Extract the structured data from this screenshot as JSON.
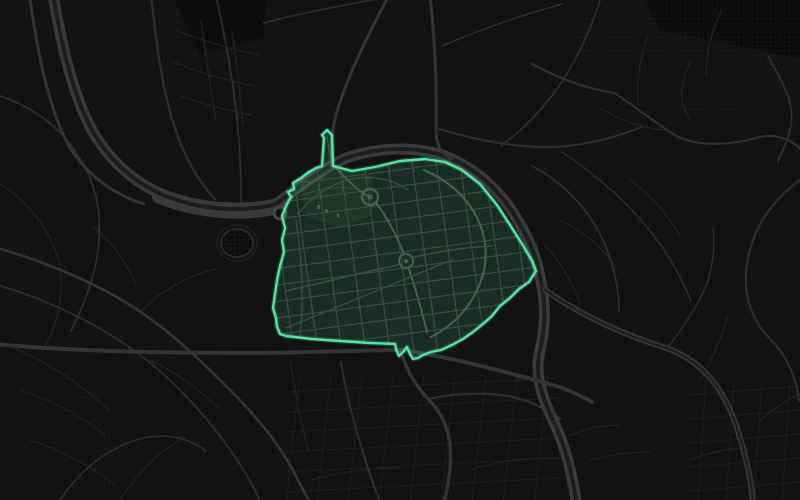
{
  "map": {
    "canvas": {
      "width": 800,
      "height": 500
    },
    "palette": {
      "background": "#121212",
      "block": "#0c0c0c",
      "dot": "#232323",
      "grid_faint": "#1e1e1e",
      "road_thin": "#242424",
      "road_medium": "#2e2e2e",
      "road_major": "#343434",
      "water": "#3a3a3a",
      "water_core": "#1d1d1d",
      "landmark_ring": "#454545",
      "stadium_fill": "#0e0e0e",
      "stadium_stroke": "#282828",
      "district_street": "#3a4f43",
      "district_street_bright": "#485f50"
    },
    "blocks": [
      "M 172,-5 L 266,-5 L 264,38 L 200,54 Z",
      "M 640,-5 L 805,-5 L 805,60 L 660,30 Z"
    ],
    "texture_patches": [
      {
        "d": "M 560,20 L 660,-5 L 805,-5 L 805,95 L 700,120 L 600,80 Z",
        "opacity": 0.55
      },
      {
        "d": "M -5,205 L 40,215 L 70,260 L 60,320 L 5,330 Z",
        "opacity": 0.5
      },
      {
        "d": "M -5,355 L 120,385 L 230,455 L 260,505 L -5,505 Z",
        "opacity": 0.45
      },
      {
        "d": "M 95,-5 L 170,-5 L 198,58 L 150,118 L 100,80 Z",
        "opacity": 0.5
      }
    ],
    "grids": [
      {
        "n": 6,
        "x1": 284,
        "y1": 392,
        "x2": 560,
        "y2": 378,
        "sx": 0,
        "sy": 20
      },
      {
        "n": 9,
        "x1": 300,
        "y1": 375,
        "x2": 286,
        "y2": 503,
        "sx": 31,
        "sy": 0
      },
      {
        "n": 5,
        "x1": 688,
        "y1": 395,
        "x2": 802,
        "y2": 386,
        "sx": 0,
        "sy": 24
      },
      {
        "n": 4,
        "x1": 706,
        "y1": 380,
        "x2": 698,
        "y2": 503,
        "sx": 28,
        "sy": 0
      }
    ],
    "water": {
      "wide_d": "M 160,196 C 200,212 245,214 278,206",
      "d": "M 52,-10 C 60,35 70,90 93,132 C 112,164 138,185 168,197 C 205,211 248,212 276,204 C 298,188 320,170 346,158 C 382,146 420,146 450,158 C 480,171 502,194 517,219 C 529,239 536,256 539,272 C 545,297 547,322 540,350 C 533,378 545,403 557,429 C 566,450 572,473 576,500"
    },
    "roads": {
      "major": [
        {
          "d": "M 545,290 C 585,318 628,336 666,348 C 700,360 722,385 736,425 C 746,455 751,478 753,502",
          "w": 6,
          "core": 2
        },
        {
          "d": "M -5,344 C 80,352 180,353 266,353 C 320,352 370,350 400,350 C 440,355 492,368 546,383 C 565,388 580,395 592,402",
          "w": 4
        },
        {
          "d": "M 403,357 C 408,374 418,388 428,399 C 441,412 448,426 450,446 C 452,466 448,486 444,502",
          "w": 3.5
        },
        {
          "d": "M 430,-5 C 435,40 437,90 436,130 C 436,146 441,153 452,159",
          "w": 3
        },
        {
          "d": "M 390,-6 C 371,28 352,68 341,99 C 334,118 330,141 331,164",
          "w": 3
        },
        {
          "d": "M 29,-8 C 37,50 48,108 70,148 C 88,176 113,194 144,204",
          "w": 3
        },
        {
          "d": "M -6,247 C 40,260 90,280 130,305 C 170,330 201,361 230,390 C 256,416 281,446 296,476 C 302,488 307,497 310,503",
          "w": 2.6
        }
      ],
      "medium": [
        {
          "d": "M 151,-4 C 156,40 161,80 171,115 C 181,150 196,180 216,200",
          "w": 2.2
        },
        {
          "d": "M 216,-4 C 226,40 233,80 237,120 C 241,158 242,190 240,218",
          "w": 1.8
        },
        {
          "d": "M 264,23 C 300,13 340,6 393,-4",
          "w": 1.8
        },
        {
          "d": "M 436,128 C 472,139 506,146 540,147 C 572,148 606,141 642,127",
          "w": 2
        },
        {
          "d": "M 442,46 C 482,29 522,15 562,4",
          "w": 1.6
        },
        {
          "d": "M 602,-6 C 591,30 576,62 557,89 C 541,111 521,131 501,146",
          "w": 1.6
        },
        {
          "d": "M 532,64 C 560,79 588,89 614,93 C 635,106 656,124 678,137 C 701,147 731,145 756,138 C 776,132 792,140 803,151",
          "w": 2.2
        },
        {
          "d": "M 768,56 C 781,80 795,101 791,126 C 787,146 779,156 778,162",
          "w": 1.8
        },
        {
          "d": "M 803,178 C 772,199 752,229 747,264 C 742,295 752,321 771,340 C 786,355 796,376 799,401",
          "w": 2
        },
        {
          "d": "M 532,166 C 561,181 586,206 601,236 C 613,261 619,286 619,312",
          "w": 1.8
        },
        {
          "d": "M 562,152 C 592,172 621,196 646,226 C 666,250 681,276 691,301",
          "w": 1.4
        },
        {
          "d": "M 428,399 C 452,394 477,392 501,395 C 521,397 542,406 560,419",
          "w": 2.2
        },
        {
          "d": "M 341,362 C 346,392 353,422 363,452 C 369,472 376,492 381,503",
          "w": 1.8
        },
        {
          "d": "M -6,284 C 50,300 100,325 140,355 C 176,382 206,416 231,451 C 246,473 256,491 261,503",
          "w": 1.7
        },
        {
          "d": "M 58,503 C 79,471 105,450 136,440 C 161,432 186,436 206,451",
          "w": 1.5
        },
        {
          "d": "M -6,94 C 30,105 61,126 81,160 C 96,185 101,211 99,241 C 97,271 86,301 71,331",
          "w": 1.7
        },
        {
          "d": "M 668,347 C 682,329 696,309 706,286 C 713,266 715,246 713,229",
          "w": 1.5
        }
      ],
      "thin": [
        {
          "d": "M 176,30 C 205,42 233,50 261,55",
          "w": 1.2
        },
        {
          "d": "M 171,61 C 200,73 228,81 256,86",
          "w": 1.2
        },
        {
          "d": "M 181,96 C 205,105 230,111 252,115",
          "w": 1.2
        },
        {
          "d": "M 201,21 C 206,55 210,88 216,119",
          "w": 1.2
        },
        {
          "d": "M 232,31 C 237,62 240,94 243,124",
          "w": 1.2
        },
        {
          "d": "M -6,180 C 25,198 50,228 59,262 C 66,292 58,324 42,351",
          "w": 1.3
        },
        {
          "d": "M 92,226 C 111,241 126,261 136,286",
          "w": 1.2
        },
        {
          "d": "M 141,311 C 161,291 186,276 216,269",
          "w": 1.2
        },
        {
          "d": "M -4,341 C 38,356 78,381 110,411",
          "w": 1.2
        },
        {
          "d": "M 120,500 C 140,470 160,450 185,438",
          "w": 1.2
        },
        {
          "d": "M 20,390 C 50,400 80,415 105,435",
          "w": 1
        },
        {
          "d": "M 30,440 C 60,450 90,465 115,485",
          "w": 1
        },
        {
          "d": "M 150,360 C 175,372 198,388 218,408",
          "w": 1
        },
        {
          "d": "M 690,62 C 681,82 677,102 691,121",
          "w": 1.2
        },
        {
          "d": "M 722,10 C 712,30 706,52 706,75",
          "w": 1.2
        },
        {
          "d": "M 648,35 C 640,58 636,82 638,106",
          "w": 1.2
        },
        {
          "d": "M 600,108 C 620,120 642,128 664,130",
          "w": 1.2
        },
        {
          "d": "M 560,220 C 580,230 600,245 615,265",
          "w": 1.2
        },
        {
          "d": "M 630,180 C 650,195 668,214 680,236",
          "w": 1.2
        },
        {
          "d": "M 545,245 C 560,262 572,282 580,304",
          "w": 1.2
        },
        {
          "d": "M 700,380 C 712,360 722,338 728,314",
          "w": 1.2
        },
        {
          "d": "M 760,420 C 775,408 790,398 803,392",
          "w": 1.2
        },
        {
          "d": "M 690,460 C 710,452 730,448 750,448",
          "w": 1.2
        },
        {
          "d": "M 310,480 C 340,472 370,468 400,468",
          "w": 1
        },
        {
          "d": "M 470,470 C 495,462 520,458 545,458",
          "w": 1
        },
        {
          "d": "M 560,440 C 580,430 600,425 620,425",
          "w": 1
        },
        {
          "d": "M 590,460 C 610,455 630,452 650,452",
          "w": 1
        },
        {
          "d": "M 290,360 C 295,390 300,420 308,450",
          "w": 1.2
        }
      ]
    },
    "landmarks": {
      "roundabout": {
        "cx": 280,
        "cy": 213,
        "r": 6,
        "ring_w": 3
      },
      "stadium": {
        "cx": 237,
        "cy": 243,
        "rx": 16,
        "ry": 14,
        "outer_rx": 20,
        "outer_ry": 18
      }
    },
    "highlight_region": {
      "stroke_color": "#56e5a0",
      "fill_opacity": 0.13,
      "glow_width": 5,
      "glow_opacity": 0.2,
      "stroke_width": 2.4,
      "outline": [
        [
          322,
          166
        ],
        [
          324,
          138
        ],
        [
          322,
          135
        ],
        [
          327,
          130
        ],
        [
          332,
          135
        ],
        [
          333,
          166
        ],
        [
          352,
          171
        ],
        [
          375,
          167
        ],
        [
          400,
          161
        ],
        [
          425,
          159
        ],
        [
          445,
          162
        ],
        [
          462,
          170
        ],
        [
          480,
          184
        ],
        [
          497,
          205
        ],
        [
          512,
          228
        ],
        [
          524,
          247
        ],
        [
          532,
          261
        ],
        [
          536,
          271
        ],
        [
          529,
          282
        ],
        [
          519,
          289
        ],
        [
          510,
          298
        ],
        [
          500,
          306
        ],
        [
          492,
          316
        ],
        [
          483,
          324
        ],
        [
          473,
          332
        ],
        [
          463,
          339
        ],
        [
          452,
          345
        ],
        [
          441,
          350
        ],
        [
          431,
          352
        ],
        [
          423,
          355
        ],
        [
          418,
          358
        ],
        [
          413,
          359
        ],
        [
          410,
          354
        ],
        [
          407,
          347
        ],
        [
          403,
          352
        ],
        [
          399,
          356
        ],
        [
          396,
          349
        ],
        [
          395,
          344
        ],
        [
          370,
          343
        ],
        [
          340,
          341
        ],
        [
          312,
          339
        ],
        [
          286,
          336
        ],
        [
          280,
          334
        ],
        [
          277,
          327
        ],
        [
          276,
          318
        ],
        [
          273,
          308
        ],
        [
          275,
          294
        ],
        [
          277,
          280
        ],
        [
          280,
          266
        ],
        [
          284,
          252
        ],
        [
          282,
          240
        ],
        [
          285,
          228
        ],
        [
          282,
          216
        ],
        [
          287,
          204
        ],
        [
          291,
          197
        ],
        [
          288,
          192
        ],
        [
          294,
          189
        ],
        [
          293,
          183
        ],
        [
          301,
          178
        ],
        [
          309,
          172
        ],
        [
          316,
          168
        ]
      ],
      "park_d": "M 300,182 L 340,170 L 372,174 L 374,214 L 340,228 L 306,216 Z",
      "park_opacity": 0.06,
      "interior_grid": [
        {
          "n": 11,
          "x1": 262,
          "y1": 188,
          "x2": 548,
          "y2": 150,
          "sx": 0,
          "sy": 16.5
        },
        {
          "n": 12,
          "x1": 266,
          "y1": 148,
          "x2": 294,
          "y2": 352,
          "sx": 24,
          "sy": 0
        }
      ],
      "streets": [
        {
          "d": "M 424,170 C 470,190 492,230 484,270 C 477,300 458,323 431,337",
          "w": 2.2,
          "b": true
        },
        {
          "d": "M 330,161 C 347,181 359,191 369,197",
          "w": 2,
          "b": true
        },
        {
          "d": "M 377,204 C 390,222 399,241 404,254",
          "w": 2,
          "b": true
        },
        {
          "d": "M 409,269 C 416,290 422,312 427,332",
          "w": 2,
          "b": true
        },
        {
          "d": "M 286,291 C 330,281 364,272 398,265",
          "w": 1.6
        },
        {
          "d": "M 414,257 C 445,250 470,247 492,246",
          "w": 1.6
        },
        {
          "d": "M 298,214 C 312,196 330,184 352,179 C 372,175 392,179 408,190",
          "w": 1.4
        },
        {
          "d": "M 300,196 C 320,188 340,186 358,189",
          "w": 1
        },
        {
          "d": "M 286,328 L 454,259",
          "w": 1.3
        },
        {
          "d": "M 327,136 L 331,162",
          "w": 1.5
        },
        {
          "d": "M 335,165 C 370,162 405,158 440,161",
          "w": 1.4
        },
        {
          "d": "M 296,220 C 302,260 304,300 300,336",
          "w": 1.3
        }
      ],
      "roundabouts": [
        {
          "cx": 370,
          "cy": 197,
          "r": 8,
          "w": 2.4,
          "ir": 2.6
        },
        {
          "cx": 406,
          "cy": 261,
          "r": 7,
          "w": 2,
          "ir": 2.2
        }
      ],
      "details": [
        {
          "x": 317,
          "y": 205,
          "w": 3,
          "h": 4
        },
        {
          "x": 325,
          "y": 209,
          "w": 3,
          "h": 4
        },
        {
          "x": 337,
          "y": 214,
          "w": 2.5,
          "h": 3.5
        }
      ]
    }
  }
}
